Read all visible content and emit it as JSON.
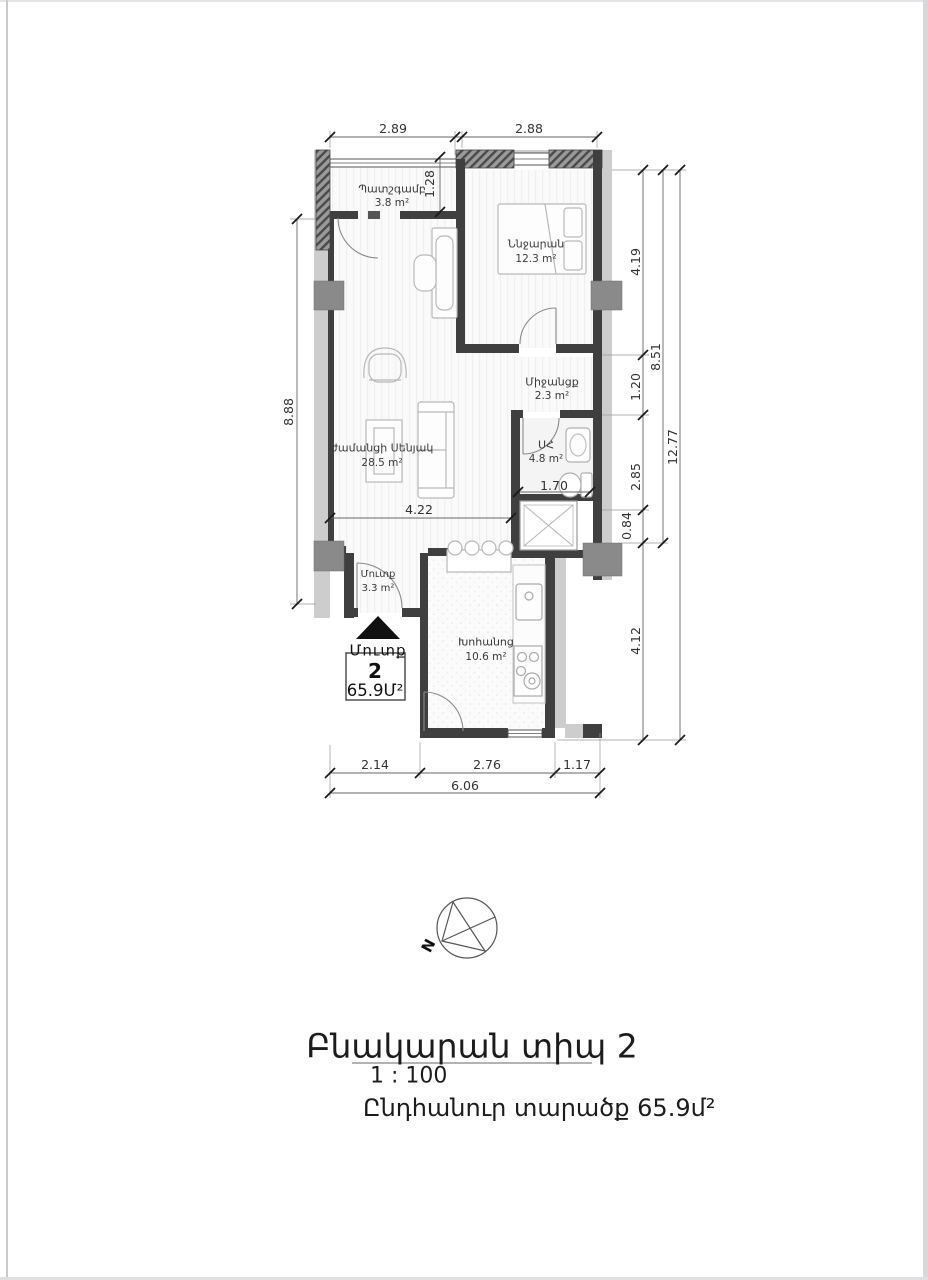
{
  "colors": {
    "wall": "#3f3f3f",
    "wall_light": "#cdcdcd",
    "column": "#8a8a8a",
    "dim_line": "#555555",
    "text": "#222222"
  },
  "rooms": {
    "balcony": {
      "name": "Պատշգամբ",
      "area": "3.8 m²"
    },
    "bedroom": {
      "name": "Ննջարան",
      "area": "12.3 m²"
    },
    "hallway": {
      "name": "Միջանցք",
      "area": "2.3 m²"
    },
    "living_room": {
      "name": "ժամանցի Սենյակ",
      "area": "28.5 m²"
    },
    "bathroom": {
      "name": "ՍՀ",
      "area": "4.8 m²"
    },
    "entry": {
      "name": "Մուտք",
      "area": "3.3 m²"
    },
    "kitchen": {
      "name": "Խոհանոց",
      "area": "10.6 m²"
    }
  },
  "dims": {
    "top": [
      "2.89",
      "2.88"
    ],
    "balcony_depth": "1.28",
    "left": "8.88",
    "right": [
      "4.19",
      "1.20",
      "2.85",
      "0.84",
      "8.51",
      "12.77",
      "4.12"
    ],
    "bottom": [
      "2.14",
      "2.76",
      "1.17",
      "6.06"
    ],
    "living_width": "4.22",
    "bath_width": "1.70"
  },
  "entrance": {
    "label": "Մուտք"
  },
  "unit_box": {
    "number": "2",
    "area": "65.9Մ²"
  },
  "compass": {
    "north": "N"
  },
  "title_block": {
    "title": "Բնակարան տիպ 2",
    "scale": "1 : 100",
    "total_area": "Ընդհանուր տարածք 65.9մ²"
  }
}
